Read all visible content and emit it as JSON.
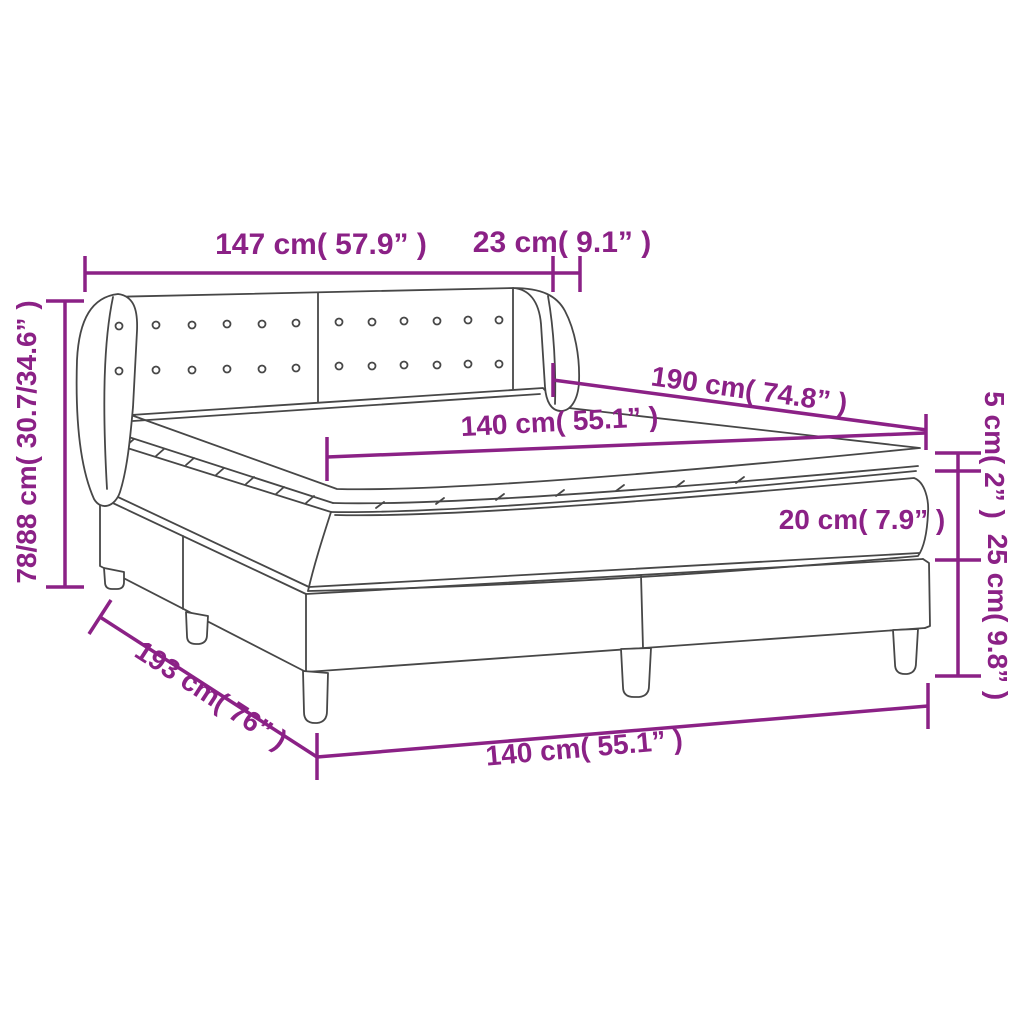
{
  "diagram": {
    "type": "product-dimension-diagram",
    "subject": "box spring bed with winged headboard, mattress and topper",
    "colors": {
      "dimension": "#8B2186",
      "artwork": "#474747",
      "background": "#FFFFFF"
    }
  },
  "labels": {
    "headboard_width": "147 cm( 57.9” )",
    "wing_depth": "23 cm( 9.1” )",
    "bed_length": "190 cm( 74.8” )",
    "mattress_width": "140 cm( 55.1” )",
    "topper_height": "5 cm( 2” )",
    "mattress_height": "20 cm( 7.9” )",
    "base_height": "25 cm( 9.8” )",
    "overall_height": "78/88 cm( 30.7/34.6” )",
    "base_length": "193 cm( 76” )",
    "base_width": "140 cm( 55.1” )"
  }
}
